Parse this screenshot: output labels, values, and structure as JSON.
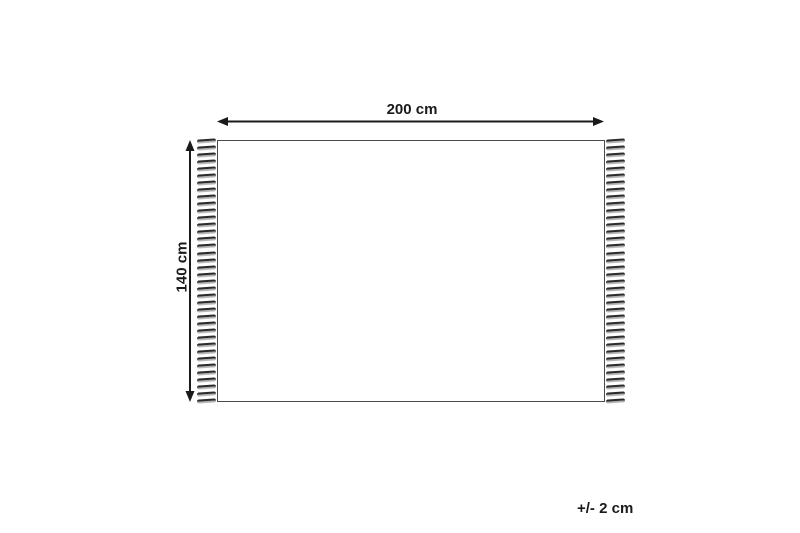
{
  "diagram": {
    "width_label": "200 cm",
    "height_label": "140 cm",
    "tolerance_label": "+/- 2 cm",
    "fringe_count_per_side": 38,
    "colors": {
      "background": "#ffffff",
      "line": "#1a1a1a",
      "rug_border": "#4a4a4a",
      "tassel_dark": "#2b2b2b",
      "tassel_light": "#c4c4c4"
    }
  }
}
